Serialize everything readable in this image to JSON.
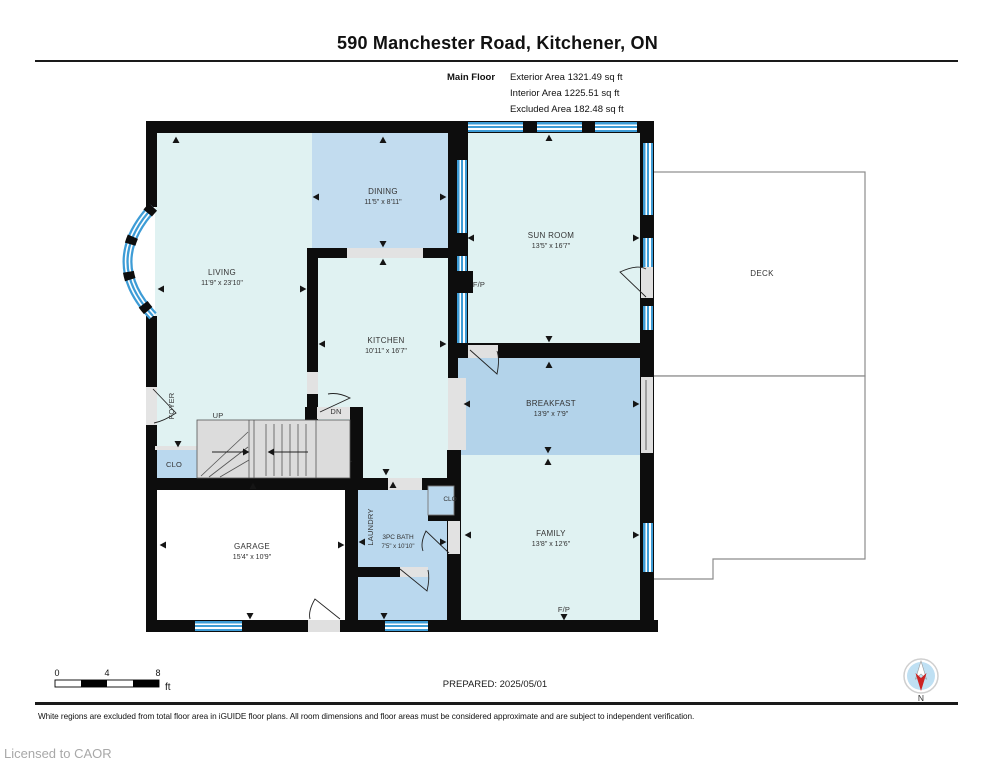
{
  "header": {
    "title": "590 Manchester Road, Kitchener, ON",
    "floor_label": "Main Floor",
    "area_lines": [
      "Exterior Area 1321.49 sq ft",
      "Interior Area 1225.51 sq ft",
      "Excluded Area 182.48 sq ft"
    ]
  },
  "plan": {
    "rooms": {
      "living": {
        "name": "LIVING",
        "dims": "11'9\" x 23'10\""
      },
      "dining": {
        "name": "DINING",
        "dims": "11'5\" x 8'11\""
      },
      "kitchen": {
        "name": "KITCHEN",
        "dims": "10'11\" x 16'7\""
      },
      "sunroom": {
        "name": "SUN ROOM",
        "dims": "13'5\" x 16'7\""
      },
      "breakfast": {
        "name": "BREAKFAST",
        "dims": "13'9\" x 7'9\""
      },
      "family": {
        "name": "FAMILY",
        "dims": "13'8\" x 12'6\""
      },
      "garage": {
        "name": "GARAGE",
        "dims": "15'4\" x 10'9\""
      },
      "bath": {
        "name": "3PC BATH",
        "dims": "7'5\" x 10'10\""
      }
    },
    "labels": {
      "deck": "DECK",
      "foyer": "FOYER",
      "laundry": "LAUNDRY",
      "up": "UP",
      "dn": "DN",
      "clo_foyer": "CLO",
      "clo_bath": "CLO",
      "fp_sunroom": "F/P",
      "fp_family": "F/P"
    }
  },
  "scale_bar": {
    "tick_0": "0",
    "tick_4": "4",
    "tick_8": "8",
    "unit": "ft"
  },
  "compass": {
    "label": "N"
  },
  "footer": {
    "prepared": "PREPARED: 2025/05/01",
    "disclaimer": "White regions are excluded from total floor area in iGUIDE floor plans. All room dimensions and floor areas must be considered approximate and are subject to independent verification.",
    "license": "Licensed to CAOR"
  },
  "colors": {
    "room_pale": "#E0F2F2",
    "dining_blue": "#C2DCEF",
    "breakfast_blue": "#B3D3EA",
    "utility_blue": "#BAD8EE",
    "window_blue": "#3D9CD6",
    "wall_black": "#0D0D0D",
    "floor_gray": "#DEDEDE",
    "deck_border": "#8C8C8C"
  }
}
